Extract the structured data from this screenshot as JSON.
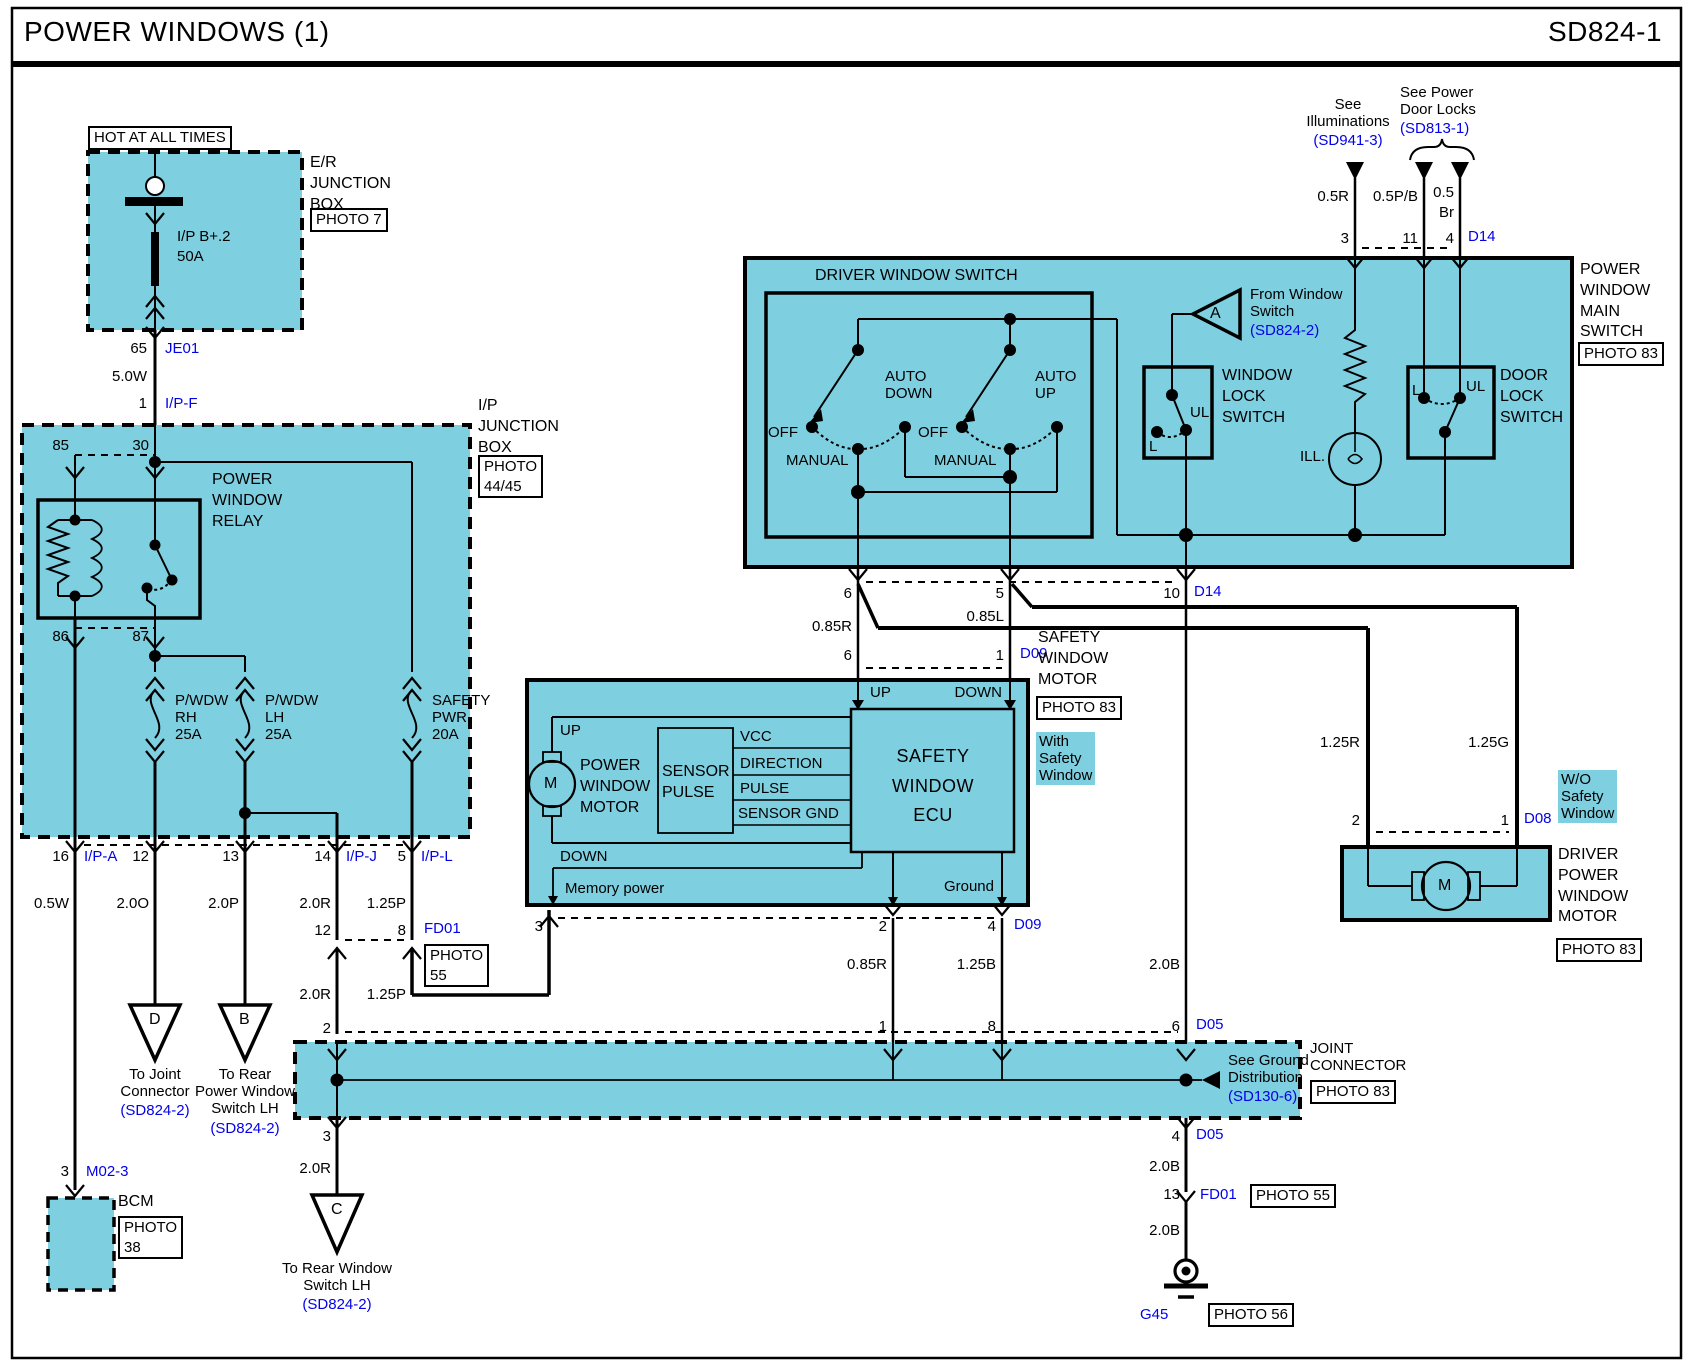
{
  "header": {
    "title": "POWER WINDOWS (1)",
    "code": "SD824-1"
  },
  "er": {
    "hot": "HOT AT ALL TIMES",
    "name": "E/R\nJUNCTION\nBOX",
    "photo": "PHOTO 7",
    "fuse": "I/P B+.2",
    "amp": "50A",
    "p65": "65",
    "je01": "JE01",
    "w50w": "5.0W",
    "p1": "1",
    "ipf": "I/P-F"
  },
  "ip": {
    "name": "I/P\nJUNCTION\nBOX",
    "photo": "PHOTO\n44/45",
    "p85": "85",
    "p30": "30",
    "relay": "POWER\nWINDOW\nRELAY",
    "p86": "86",
    "p87": "87",
    "frh": "P/WDW\nRH\n25A",
    "flh": "P/WDW\nLH\n25A",
    "fsw": "SAFETY\nPWR\n20A",
    "p16": "16",
    "ipa": "I/P-A",
    "p12": "12",
    "p13": "13",
    "p14": "14",
    "ipj": "I/P-J",
    "p5": "5",
    "ipl": "I/P-L",
    "w05w": "0.5W",
    "w20o": "2.0O",
    "w20p": "2.0P",
    "w20r": "2.0R",
    "w125p": "1.25P"
  },
  "bcm": {
    "p3": "3",
    "m023": "M02-3",
    "name": "BCM",
    "photo": "PHOTO\n38"
  },
  "td": {
    "l": "D",
    "t": "To Joint\nConnector",
    "r": "(SD824-2)"
  },
  "tb": {
    "l": "B",
    "t": "To Rear\nPower Window\nSwitch LH",
    "r": "(SD824-2)"
  },
  "tc": {
    "p3": "3",
    "w": "2.0R",
    "l": "C",
    "t": "To Rear Window\nSwitch LH",
    "r": "(SD824-2)"
  },
  "fd01": {
    "p12": "12",
    "p8": "8",
    "name": "FD01",
    "photo": "PHOTO\n55",
    "w20r": "2.0R",
    "w125p": "1.25P",
    "p2": "2"
  },
  "msw": {
    "see_ill": "See\nIlluminations",
    "sd941": "(SD941-3)",
    "see_pdl": "See Power\nDoor Locks",
    "sd813": "(SD813-1)",
    "w05r": "0.5R",
    "w05pb": "0.5P/B",
    "w05": "0.5",
    "br": "Br",
    "p3": "3",
    "p11": "11",
    "p4": "4",
    "d14": "D14",
    "title": "DRIVER WINDOW SWITCH",
    "autodown": "AUTO\nDOWN",
    "autoup": "AUTO\nUP",
    "off1": "OFF",
    "man1": "MANUAL",
    "off2": "OFF",
    "man2": "MANUAL",
    "a": "A",
    "from_ws": "From Window\nSwitch",
    "sd824": "(SD824-2)",
    "wl": "WINDOW\nLOCK\nSWITCH",
    "ul1": "UL",
    "l1": "L",
    "ill": "ILL.",
    "l2": "L",
    "ul2": "UL",
    "dl": "DOOR\nLOCK\nSWITCH",
    "name": "POWER\nWINDOW\nMAIN\nSWITCH",
    "photo": "PHOTO 83",
    "p6": "6",
    "p5": "5",
    "p10": "10",
    "d14b": "D14",
    "w085r": "0.85R",
    "w085l": "0.85L",
    "p6b": "6",
    "p1b": "1",
    "d09": "D09",
    "w20b": "2.0B"
  },
  "smotor": {
    "up_pin": "UP",
    "down_pin": "DOWN",
    "up_in": "UP",
    "pwm": "POWER\nWINDOW\nMOTOR",
    "m": "M",
    "sensor": "SENSOR\nPULSE",
    "vcc": "VCC",
    "dir": "DIRECTION",
    "pulse": "PULSE",
    "sgnd": "SENSOR GND",
    "ecu": "SAFETY\nWINDOW\nECU",
    "down_in": "DOWN",
    "mem": "Memory power",
    "gnd": "Ground",
    "p3": "3",
    "p2": "2",
    "p4": "4",
    "d09": "D09",
    "w085r": "0.85R",
    "w125b": "1.25B",
    "name": "SAFETY\nWINDOW\nMOTOR",
    "photo": "PHOTO 83",
    "with_sw": "With\nSafety\nWindow"
  },
  "dmotor": {
    "w125r": "1.25R",
    "w125g": "1.25G",
    "p2": "2",
    "p1": "1",
    "d08": "D08",
    "wo": "W/O\nSafety\nWindow",
    "name": "DRIVER\nPOWER\nWINDOW\nMOTOR",
    "photo": "PHOTO 83",
    "m": "M"
  },
  "joint": {
    "p1": "1",
    "p8": "8",
    "p6": "6",
    "d05": "D05",
    "see_gnd": "See Ground\nDistribution",
    "sd130": "(SD130-6)",
    "name": "JOINT\nCONNECTOR",
    "photo": "PHOTO 83",
    "p4": "4",
    "d05b": "D05",
    "w20b": "2.0B",
    "p13": "13",
    "fd01": "FD01",
    "photo55": "PHOTO 55",
    "w20b2": "2.0B",
    "g45": "G45",
    "photo56": "PHOTO 56"
  },
  "colors": {
    "component_fill": "#7ECFE0",
    "link_blue": "#0202e8",
    "line": "#000000"
  }
}
